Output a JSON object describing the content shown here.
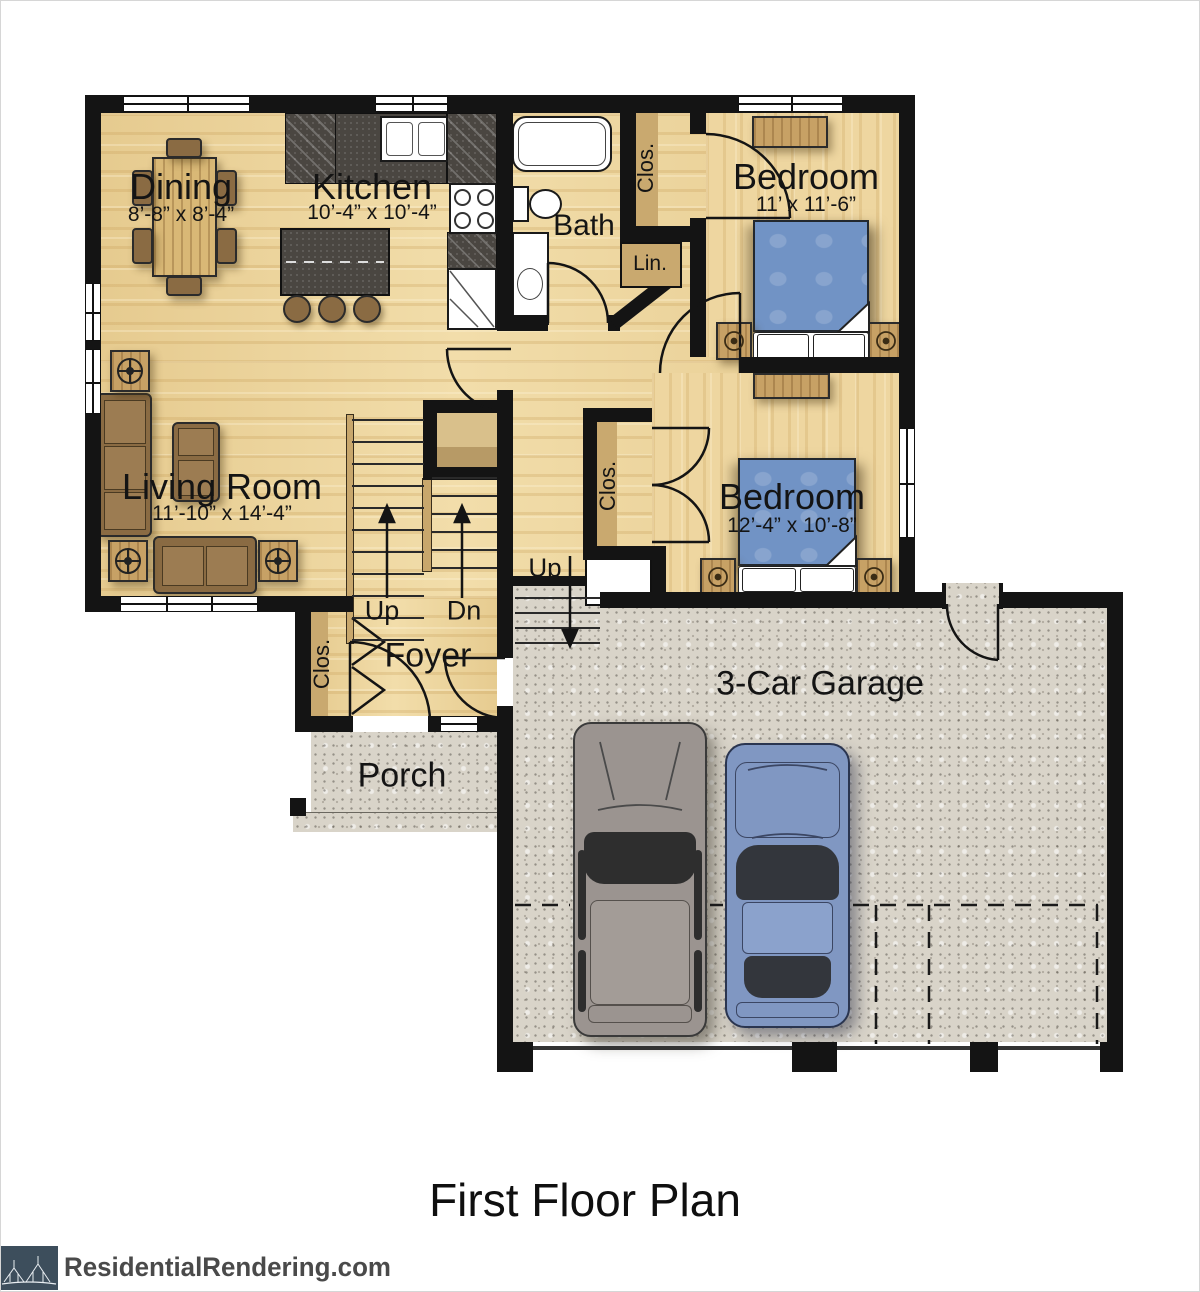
{
  "title": "First Floor Plan",
  "branding": {
    "logo_text": "ResidentialRendering.com"
  },
  "labels": {
    "dining": {
      "name": "Dining",
      "dims": "8’-8” x 8’-4”"
    },
    "kitchen": {
      "name": "Kitchen",
      "dims": "10’-4” x 10’-4”"
    },
    "bath": {
      "name": "Bath"
    },
    "bedroom1": {
      "name": "Bedroom",
      "dims": "11’ x 11’-6”"
    },
    "bedroom2": {
      "name": "Bedroom",
      "dims": "12’-4” x 10’-8”"
    },
    "living": {
      "name": "Living Room",
      "dims": "11’-10” x 14’-4”"
    },
    "foyer": {
      "name": "Foyer"
    },
    "porch": {
      "name": "Porch"
    },
    "garage": {
      "name": "3-Car Garage"
    },
    "closet_hall": "Clos.",
    "closet_foyer": "Clos.",
    "closet_bedroom2": "Clos.",
    "linen": "Lin.",
    "stairs_up": "Up",
    "stairs_down": "Dn",
    "garage_stairs_up": "Up"
  },
  "colors": {
    "wall": "#141414",
    "wood_floor": "#efd9a3",
    "concrete": "#d9d4c9",
    "counter_dark": "#4a4641",
    "bed_blue": "#7193c5",
    "furniture_brown": "#8a6b43",
    "suv_gray": "#9b9490",
    "car_blue": "#8097c2",
    "logo_navy": "#3d4e5c",
    "logo_text_gray": "#4a4a4a"
  }
}
